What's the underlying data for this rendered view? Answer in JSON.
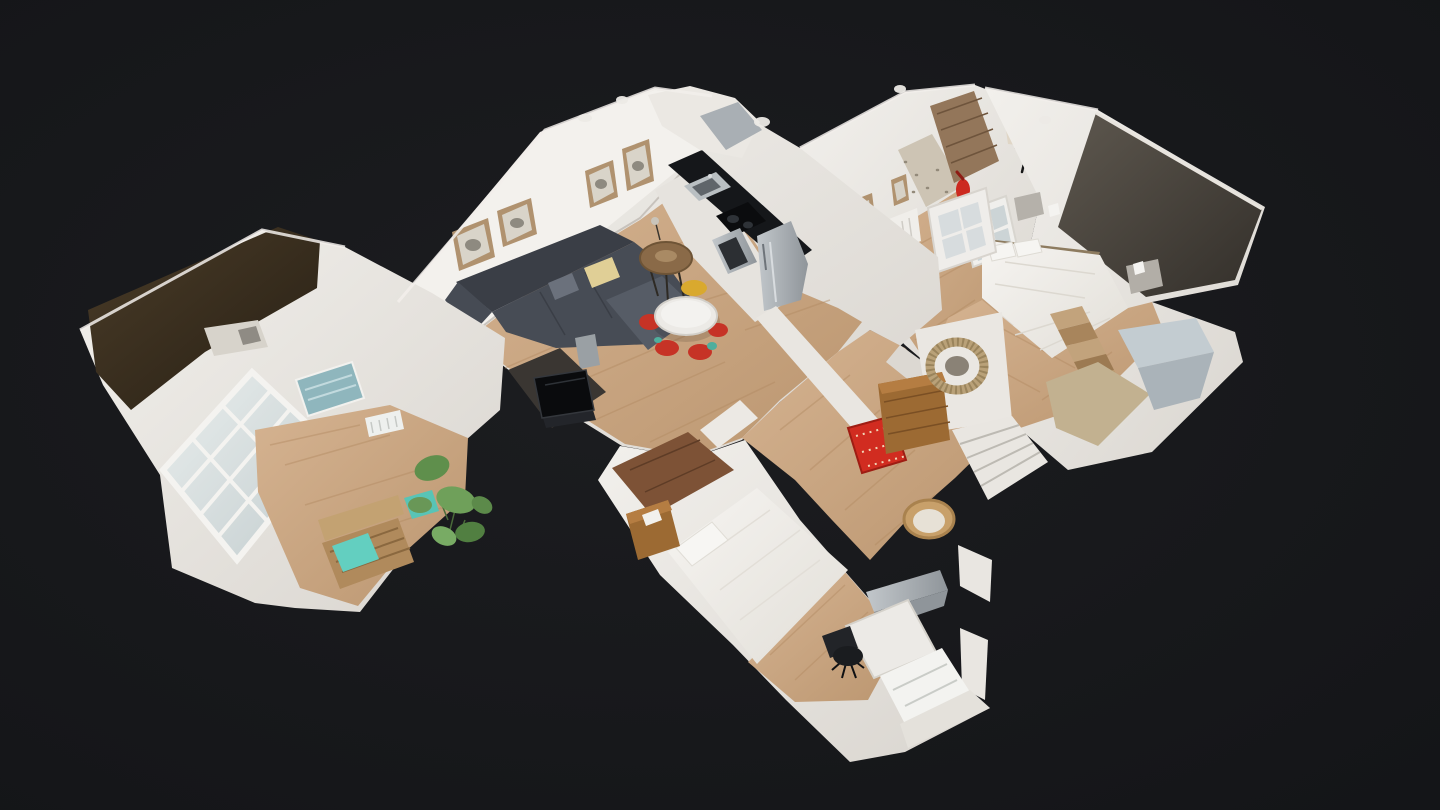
{
  "app": {
    "name": "3D dollhouse tour viewer",
    "view_mode": "dollhouse"
  },
  "canvas": {
    "background": "#17181a",
    "width": 1440,
    "height": 810
  },
  "palette": {
    "background": "#17181a",
    "wall": "#e9e6e1",
    "wall_bright": "#f3f1ed",
    "wall_shade": "#dcd8d2",
    "floor_wood": "#cbaa86",
    "floor_wood_deep": "#bf9a72",
    "floor_wood_dark": "#7d5236",
    "roof_brown": "#3b3020",
    "accent_wall": "#575149",
    "sofa": "#474c55",
    "sofa_dark": "#3a3e46",
    "sofa_light": "#565c66",
    "bed_linen": "#f0eeea",
    "pillow_yellow": "#e0cf96",
    "rug_red": "#d12c20",
    "cushion_teal": "#63cfc0",
    "chair_red": "#c63326",
    "chair_yellow": "#d9a92e",
    "art_teal": "#8fb6bd",
    "glass": "#ccd4d6",
    "frame_tan": "#b0926f",
    "counter_black": "#15171a",
    "steel": "#a7adb2",
    "door_wood": "#93765a",
    "extinguisher_red": "#cc2a20",
    "dresser_wood": "#9c6a33",
    "pallet_wood": "#b08a5c",
    "mirror_rattan": "#b9a178",
    "plant_green": "#6f9a5f",
    "tv_black": "#0a0b0d",
    "wicker": "#c8a06a",
    "table_white": "#eceae6"
  },
  "scene": {
    "model": "apartment dollhouse scan",
    "rooms": [
      "sunroom",
      "living-room",
      "kitchen",
      "entry-hallway",
      "corridor",
      "dressing-area",
      "master-bedroom",
      "second-bedroom"
    ],
    "objects": [
      "sectional-sofa",
      "dining-table",
      "red-chairs",
      "yellow-chair",
      "side-table",
      "tv",
      "kitchen-counter",
      "sink",
      "stove",
      "oven",
      "fridge",
      "picture-frames",
      "teal-artwork",
      "french-windows",
      "pallet-bench",
      "teal-cushions",
      "monstera-plant",
      "front-door",
      "fire-extinguisher",
      "coat-rack",
      "glazed-door",
      "red-runner-rug",
      "wood-dresser",
      "rattan-mirror",
      "wicker-chair",
      "white-staircase",
      "master-bed",
      "nightstands",
      "wood-stairs",
      "second-bed",
      "desk",
      "office-chair"
    ]
  }
}
